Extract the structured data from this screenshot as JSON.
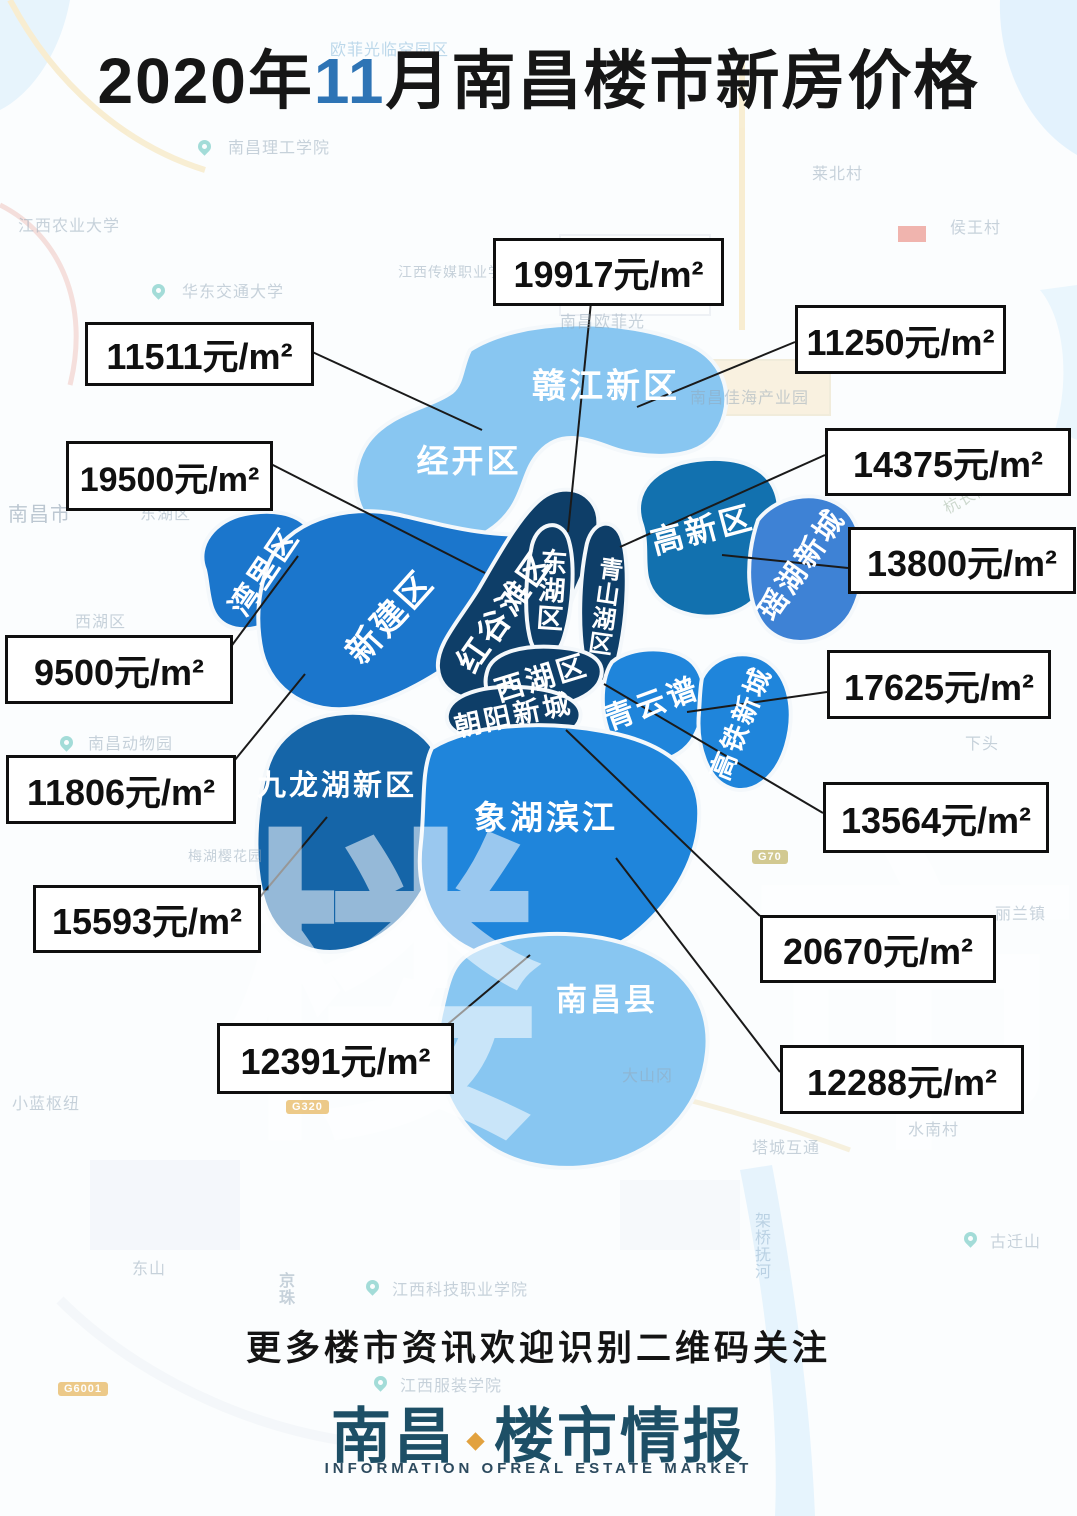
{
  "title": {
    "prefix": "2020年",
    "highlight": "11",
    "suffix": "月南昌楼市新房价格"
  },
  "palette": {
    "light_blue": "#88C6F1",
    "medium_blue": "#1B76CC",
    "navy": "#0E3E68",
    "steel_blue": "#1271AF",
    "royal_blue": "#3E82D5",
    "azure": "#1F85DB",
    "deep_blue": "#1565A8",
    "title_highlight": "#2E74B5",
    "brand_color": "#1D4F66",
    "brand_accent": "#E2A23F"
  },
  "regions": [
    {
      "name": "赣江新区",
      "price": "11250元/m²"
    },
    {
      "name": "经开区",
      "price": "11511元/m²"
    },
    {
      "name": "湾里区",
      "price": "9500元/m²"
    },
    {
      "name": "新建区",
      "price": "11806元/m²"
    },
    {
      "name": "红谷滩区",
      "price": "19500元/m²"
    },
    {
      "name": "东湖区",
      "price": "19917元/m²"
    },
    {
      "name": "青山湖区",
      "price": "14375元/m²"
    },
    {
      "name": "高新区",
      "price": "13800元/m²"
    },
    {
      "name": "瑶湖新城",
      "price": ""
    },
    {
      "name": "西湖区",
      "price": "13564元/m²"
    },
    {
      "name": "青云谱",
      "price": "17625元/m²"
    },
    {
      "name": "高铁新城",
      "price": ""
    },
    {
      "name": "朝阳新城",
      "price": "20670元/m²"
    },
    {
      "name": "九龙湖新区",
      "price": "15593元/m²"
    },
    {
      "name": "象湖滨江",
      "price": "12288元/m²"
    },
    {
      "name": "南昌县",
      "price": "12391元/m²"
    }
  ],
  "background_labels": [
    {
      "text": "欧菲光临空园区"
    },
    {
      "text": "南昌理工学院"
    },
    {
      "text": "江西农业大学"
    },
    {
      "text": "华东交通大学"
    },
    {
      "text": "江西传媒职业学院"
    },
    {
      "text": "南昌欧菲光"
    },
    {
      "text": "南昌佳海产业园"
    },
    {
      "text": "莱北村"
    },
    {
      "text": "侯王村"
    },
    {
      "text": "南昌市"
    },
    {
      "text": "东湖区"
    },
    {
      "text": "西湖区"
    },
    {
      "text": "南昌动物园"
    },
    {
      "text": "梅湖樱花园"
    },
    {
      "text": "杭长高速"
    },
    {
      "text": "下头"
    },
    {
      "text": "丽兰镇"
    },
    {
      "text": "小蓝枢纽"
    },
    {
      "text": "大山冈"
    },
    {
      "text": "塔城互通"
    },
    {
      "text": "水南村"
    },
    {
      "text": "架桥抚河"
    },
    {
      "text": "古迁山"
    },
    {
      "text": "东山"
    },
    {
      "text": "京珠"
    },
    {
      "text": "江西科技职业学院"
    },
    {
      "text": "江西服装学院"
    }
  ],
  "road_badges": [
    {
      "text": "G70"
    },
    {
      "text": "G320"
    },
    {
      "text": "G6001"
    }
  ],
  "watermarks": [
    {
      "char": "楼"
    },
    {
      "char": "市"
    }
  ],
  "footer": {
    "cta": "更多楼市资讯欢迎识别二维码关注",
    "brand_city": "南昌",
    "brand_rest": "楼市情报",
    "brand_sub": "INFORMATION OFREAL ESTATE MARKET"
  }
}
